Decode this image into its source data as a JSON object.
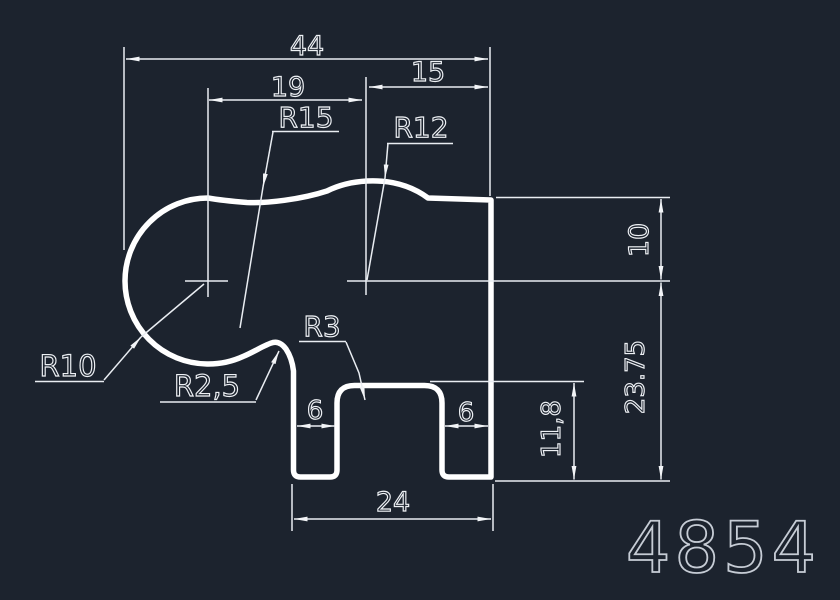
{
  "colors": {
    "background": "#1c232e",
    "geometry_line": "#ffffff",
    "dimension_line": "#e9edf2",
    "part_number_color": "#c6ccd5"
  },
  "part_number": "4854",
  "linear_dimensions": {
    "total_width": "44",
    "left_width": "19",
    "right_width": "15",
    "left_leg_width": "6",
    "right_leg_width": "6",
    "bottom_width": "24",
    "top_height": "10",
    "right_height": "23.75",
    "notch_height": "11,8"
  },
  "radius_dimensions": {
    "r15": "R15",
    "r12": "R12",
    "r10": "R10",
    "r2_5": "R2,5",
    "r3": "R3"
  }
}
